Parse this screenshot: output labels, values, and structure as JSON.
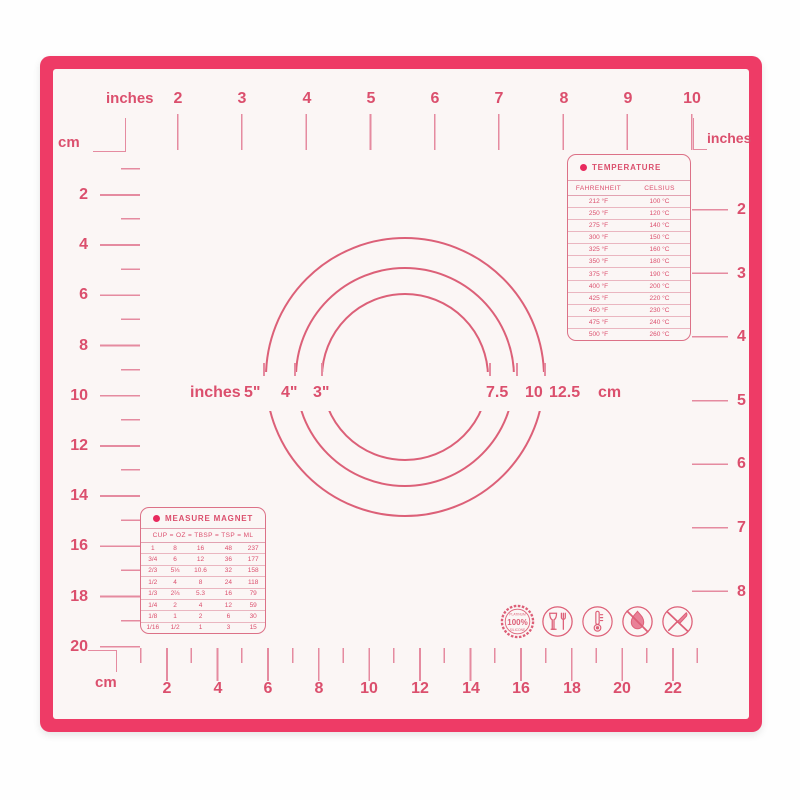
{
  "colors": {
    "frame": "#ee3b66",
    "surface": "#fbf6f5",
    "ink": "#db4f6d",
    "line": "#e58ba0"
  },
  "rulers": {
    "top": {
      "unit_left": "inches",
      "numbers": [
        "2",
        "3",
        "4",
        "5",
        "6",
        "7",
        "8",
        "9",
        "10"
      ]
    },
    "right": {
      "unit_top": "inches",
      "numbers": [
        "2",
        "3",
        "4",
        "5",
        "6",
        "7",
        "8"
      ]
    },
    "left": {
      "unit_top": "cm",
      "numbers": [
        "2",
        "4",
        "6",
        "8",
        "10",
        "12",
        "14",
        "16",
        "18",
        "20"
      ]
    },
    "bottom": {
      "unit_left": "cm",
      "numbers": [
        "2",
        "4",
        "6",
        "8",
        "10",
        "12",
        "14",
        "16",
        "18",
        "20",
        "22"
      ]
    }
  },
  "circle_guide": {
    "left_unit": "inches",
    "left_labels": [
      "5\"",
      "4\"",
      "3\""
    ],
    "right_labels": [
      "7.5",
      "10",
      "12.5"
    ],
    "right_unit": "cm"
  },
  "temperature": {
    "title": "TEMPERATURE",
    "columns": [
      "FAHRENHEIT",
      "CELSIUS"
    ],
    "rows": [
      [
        "212 °F",
        "100 °C"
      ],
      [
        "250 °F",
        "120 °C"
      ],
      [
        "275 °F",
        "140 °C"
      ],
      [
        "300 °F",
        "150 °C"
      ],
      [
        "325 °F",
        "160 °C"
      ],
      [
        "350 °F",
        "180 °C"
      ],
      [
        "375 °F",
        "190 °C"
      ],
      [
        "400 °F",
        "200 °C"
      ],
      [
        "425 °F",
        "220 °C"
      ],
      [
        "450 °F",
        "230 °C"
      ],
      [
        "475 °F",
        "240 °C"
      ],
      [
        "500 °F",
        "260 °C"
      ]
    ]
  },
  "measure": {
    "title": "MEASURE MAGNET",
    "header": "CUP = OZ = TBSP = TSP = ML",
    "rows": [
      [
        "1",
        "8",
        "16",
        "48",
        "237"
      ],
      [
        "3/4",
        "6",
        "12",
        "36",
        "177"
      ],
      [
        "2/3",
        "5⅓",
        "10.6",
        "32",
        "158"
      ],
      [
        "1/2",
        "4",
        "8",
        "24",
        "118"
      ],
      [
        "1/3",
        "2⅔",
        "5.3",
        "16",
        "79"
      ],
      [
        "1/4",
        "2",
        "4",
        "12",
        "59"
      ],
      [
        "1/8",
        "1",
        "2",
        "6",
        "30"
      ],
      [
        "1/16",
        "1/2",
        "1",
        "3",
        "15"
      ]
    ]
  },
  "badge": {
    "arc_top": "PLATINUM",
    "value": "100%",
    "arc_bottom": "SILICONE"
  }
}
